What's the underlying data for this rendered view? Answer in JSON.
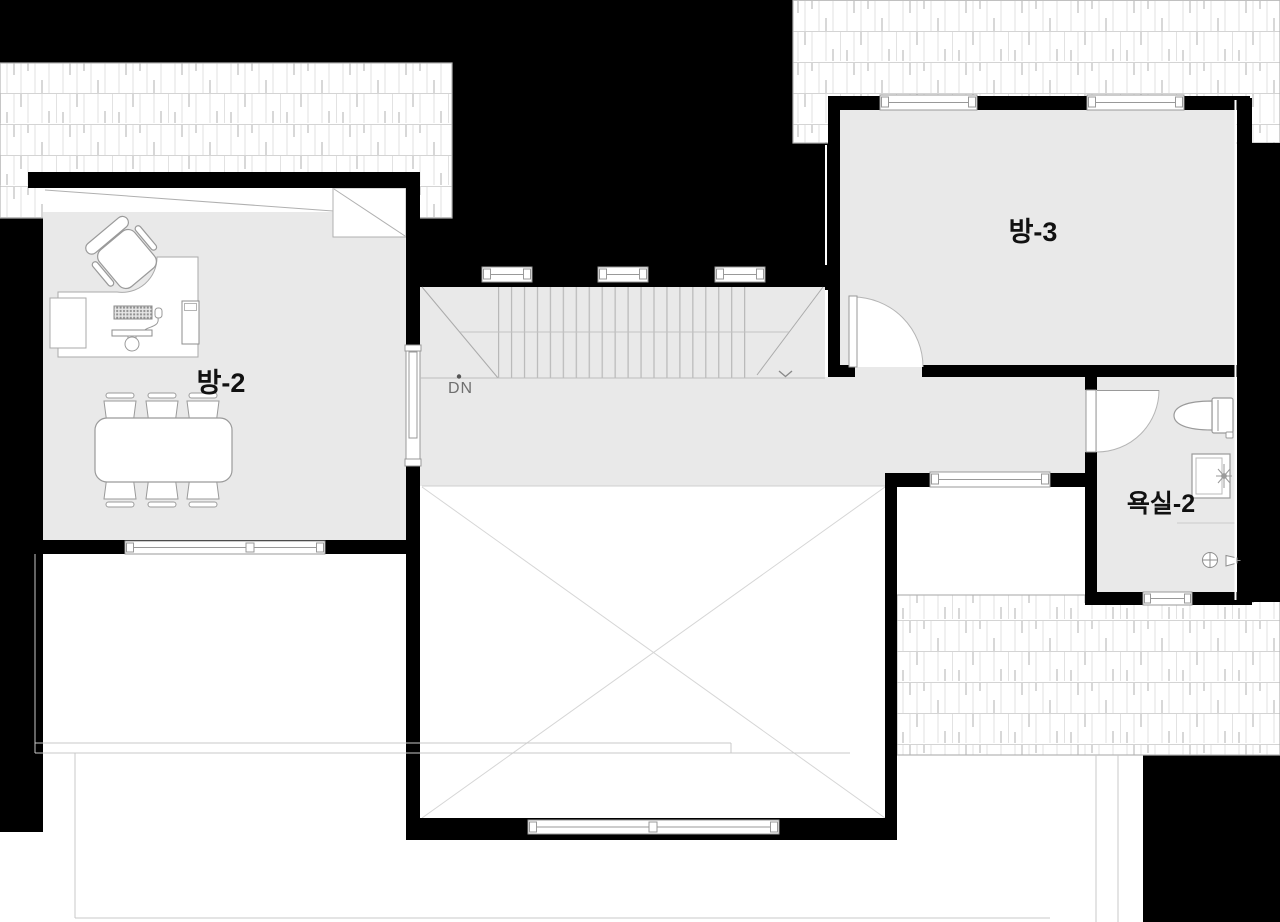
{
  "plan": {
    "type": "architectural-floor-plan",
    "floor": "2F",
    "rooms": {
      "room2_label": "방-2",
      "room3_label": "방-3",
      "bathroom_label": "욕실-2"
    },
    "stairs": {
      "direction_label": "DN"
    },
    "fixtures": [
      "office-desk",
      "office-chair",
      "computer-keyboard",
      "computer-monitor",
      "pc-tower",
      "dining-table",
      "dining-chairs-x6",
      "toilet",
      "vanity-sink",
      "floor-drain",
      "shower-head"
    ],
    "colors": {
      "wall_fill": "#000000",
      "room_floor": "#e9e9e9",
      "furniture_outline": "#9a9a9a",
      "faint_line": "#c9c9c9",
      "shingle_line": "#dcdcdc",
      "label_text": "#111111",
      "dn_text": "#6f6f6f"
    }
  }
}
